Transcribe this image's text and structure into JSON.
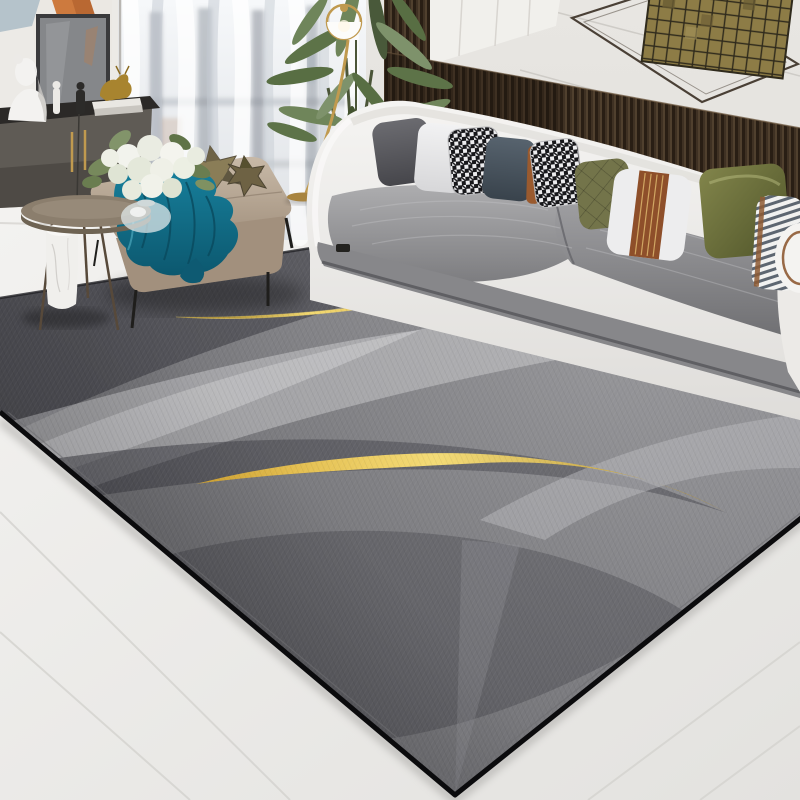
{
  "scene": {
    "type": "interior-product-photo",
    "subject": "modern abstract gray area rug with gold swoosh accents",
    "setting": "contemporary living room",
    "objects": [
      "abstract-wall-art",
      "framed-panel",
      "sideboard-cabinet",
      "bust-sculpture",
      "figurines",
      "gold-deer-ornament",
      "stacked-books",
      "sheer-curtains",
      "window",
      "round-side-table",
      "marble-pedestal",
      "glass-vase",
      "white-flower-bouquet",
      "upholstered-ottoman",
      "teal-throw-blanket",
      "star-pillows",
      "potted-plant",
      "brass-floor-lamp",
      "wood-slat-wall-panel",
      "mosaic-wall-art",
      "wire-frame-wall-art",
      "curved-white-sofa",
      "gray-velvet-seat-cushions",
      "throw-pillows",
      "striped-bolster",
      "marble-tile-floor",
      "geometric-area-rug",
      "gold-swoosh-thin",
      "gold-swoosh-thick"
    ]
  },
  "palette": {
    "wall": "#eceae6",
    "wall_right_top": "#e8e6e2",
    "wall_right_bottom": "#d8d6d2",
    "panel_white": "#f1f0ec",
    "wall_seam": "#c9c6c1",
    "wood_panel": "#3f3123",
    "wood_groove": "#291e14",
    "mosaic_gold": "#8d7c46",
    "mosaic_grout": "#2f2a1c",
    "wire_art": "#4a4036",
    "curtain_light": "#f6f8fa",
    "curtain_shade": "#c3c9d1",
    "window_hint": "#747b84",
    "floor_light": "#f3f2f0",
    "floor_dark": "#e3e2df",
    "floor_seam": "#d5d4d0",
    "rug_base_light": "#8b8b8f",
    "rug_base_dark": "#626266",
    "rug_light_band": "#c7c7ca",
    "rug_dark_band": "#3d3d43",
    "rug_edge": "#0b0b0d",
    "gold": "#d7a62e",
    "gold_light": "#f3d869",
    "gold_dark": "#a87f16",
    "teal": "#177f9b",
    "teal_dark": "#0c586f",
    "blanket_fold": "#0a4a5e",
    "ottoman": "#b7a795",
    "ottoman_front": "#a2907d",
    "sofa_shell": "#f2f1ef",
    "sofa_skirt": "#87878a",
    "plant_green": "#5d7348",
    "plant_dark": "#43532f",
    "brass": "#c09a4f",
    "marble": "#f0efec",
    "table_top": "#8b7e6d",
    "cabinet": "#5f5b55",
    "cabinet_dark": "#2b2927",
    "bust_white": "#f3f2f0",
    "art_orange": "#cd7a3e",
    "art_blue": "#b5c3cb",
    "frame_gray": "#85878a",
    "pillow_charcoal": "#56565b",
    "pillow_white": "#ededee",
    "pillow_slate": "#42505c",
    "pillow_rust": "#9a5a2e",
    "pillow_olive": "#73744a",
    "pillow_olive_satin": "#6e7240",
    "hound_dark": "#17171a",
    "hound_light": "#ececee",
    "shadow": "#141416"
  }
}
